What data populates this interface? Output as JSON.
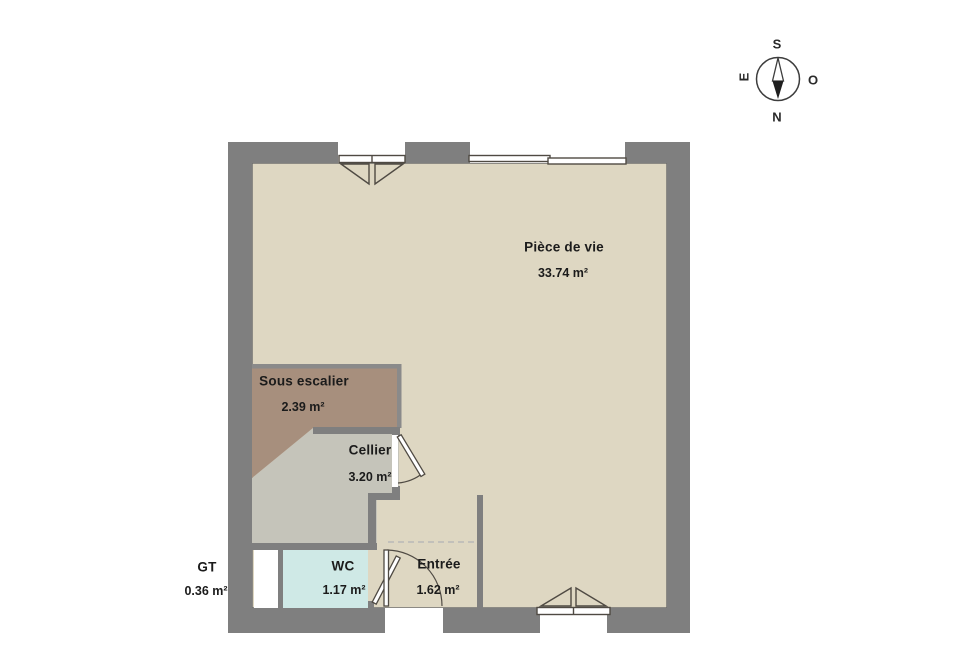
{
  "plan_title": "Rez-de-chaussée floor plan",
  "colors": {
    "wall": "#7f7f7f",
    "wallthin": "#8a8a8a",
    "floor": "#ded7c2",
    "sous": "#a78f7d",
    "cellier": "#c5c4ba",
    "wc": "#cfe9e6",
    "gt": "#ffffff",
    "line": "#4f4a43",
    "dashed": "#b8b8b8",
    "edge": "#6a6a6a",
    "text": "#1b1b1b",
    "needle": "#1f1f1f"
  },
  "rooms": [
    {
      "id": "piece-de-vie",
      "name": "Pièce de vie",
      "area": "33.74 m²"
    },
    {
      "id": "sous-escalier",
      "name": "Sous escalier",
      "area": "2.39 m²"
    },
    {
      "id": "cellier",
      "name": "Cellier",
      "area": "3.20 m²"
    },
    {
      "id": "wc",
      "name": "WC",
      "area": "1.17 m²"
    },
    {
      "id": "entree",
      "name": "Entrée",
      "area": "1.62 m²"
    },
    {
      "id": "gt",
      "name": "GT",
      "area": "0.36 m²"
    }
  ],
  "compass": {
    "top": "S",
    "bottom": "N",
    "left": "E",
    "right": "O"
  }
}
